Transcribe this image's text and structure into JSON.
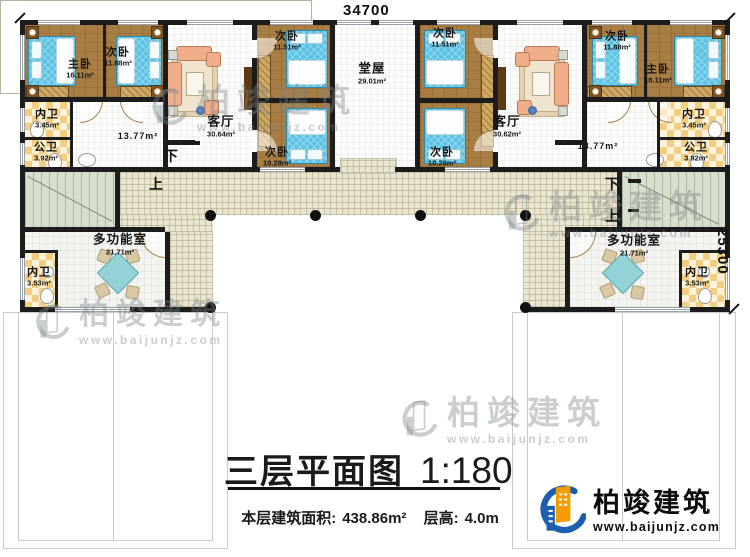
{
  "dimensions": {
    "width_top": "34700",
    "depth_right": "25300"
  },
  "stairs": {
    "down": "下",
    "up": "上"
  },
  "rooms": {
    "master_left": {
      "label": "主卧",
      "area": "16.11m²"
    },
    "second_left": {
      "label": "次卧",
      "area": "11.88m²"
    },
    "bath_inner_left": {
      "label": "内卫",
      "area": "3.45m²"
    },
    "bath_public_left": {
      "label": "公卫",
      "area": "3.92m²"
    },
    "hall_left": {
      "area": "13.77m²"
    },
    "living_left": {
      "label": "客厅",
      "area": "30.64m²"
    },
    "second_mid_left_top": {
      "label": "次卧",
      "area": "11.51m²"
    },
    "second_mid_left_bottom": {
      "label": "次卧",
      "area": "10.28m²"
    },
    "hall_center": {
      "label": "堂屋",
      "area": "29.01m²"
    },
    "second_mid_right_top": {
      "label": "次卧",
      "area": "11.51m²"
    },
    "second_mid_right_bottom": {
      "label": "次卧",
      "area": "10.28m²"
    },
    "living_right": {
      "label": "客厅",
      "area": "30.62m²"
    },
    "second_right": {
      "label": "次卧",
      "area": "11.88m²"
    },
    "master_right": {
      "label": "主卧",
      "area": "16.11m²"
    },
    "bath_inner_right": {
      "label": "内卫",
      "area": "3.45m²"
    },
    "bath_public_right": {
      "label": "公卫",
      "area": "3.92m²"
    },
    "hall_right": {
      "area": "13.77m²"
    },
    "multi_left": {
      "label": "多功能室",
      "area": "21.71m²"
    },
    "bath_wing_left": {
      "label": "内卫",
      "area": "3.53m²"
    },
    "multi_right": {
      "label": "多功能室",
      "area": "21.71m²"
    },
    "bath_wing_right": {
      "label": "内卫",
      "area": "3.53m²"
    }
  },
  "title": {
    "main": "三层平面图",
    "scale": "1:180",
    "area_label": "本层建筑面积:",
    "area_value": "438.86m²",
    "floor_height_label": "层高:",
    "floor_height_value": "4.0m"
  },
  "brand": {
    "name": "柏竣建筑",
    "website": "www.baijunjz.com"
  },
  "watermark": {
    "name": "柏竣建筑",
    "website": "www.baijunjz.com"
  },
  "colors": {
    "wall": "#1c1c1c",
    "wood_floor": "#a87e44",
    "bed": "#5cc2e4",
    "terrace": "#e9e5d1",
    "checker": "#f3cd82",
    "brand_blue": "#1d5fae",
    "brand_orange": "#f59b00"
  }
}
